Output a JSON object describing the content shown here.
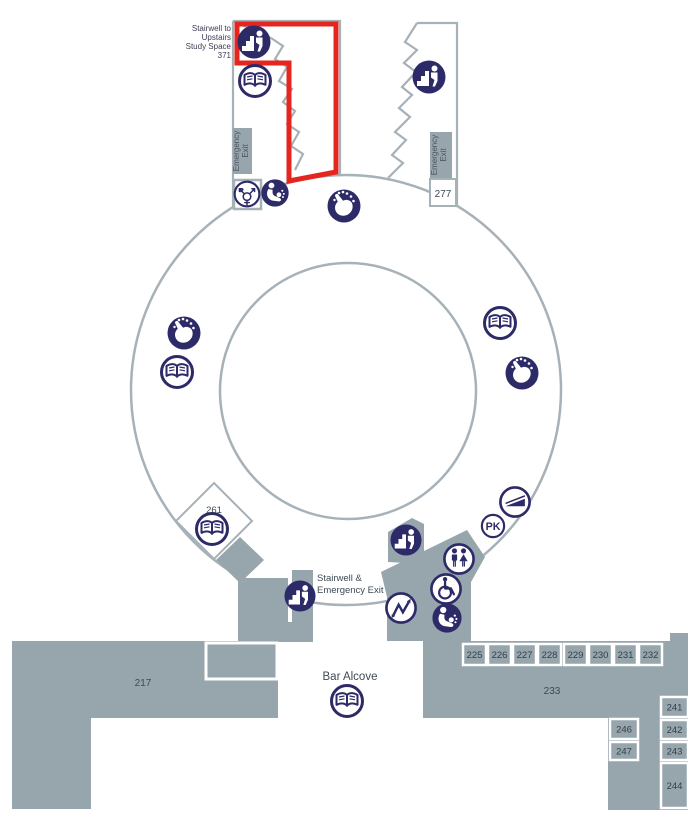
{
  "map": {
    "colors": {
      "area_gray": "#97a5ad",
      "wall_gray": "#a6b1b8",
      "icon_navy": "#2d2a68",
      "highlight_red": "#e5261f",
      "label_dark": "#3e4a54",
      "label_navy": "#3c3c55"
    },
    "highlight_label": {
      "l1": "Stairwell to",
      "l2": "Upstairs",
      "l3": "Study Space",
      "l4": "371"
    },
    "emergency_exit_label": {
      "line1": "Emergency",
      "line2": "Exit"
    },
    "stairwell_label": {
      "line1": "Stairwell &",
      "line2": "Emergency Exit"
    },
    "bar_alcove_label": "Bar Alcove",
    "pk_label": "PK",
    "room_labels": [
      {
        "id": "217",
        "x": 143,
        "y": 686,
        "s": 10
      },
      {
        "id": "233",
        "x": 552,
        "y": 694,
        "s": 10
      },
      {
        "id": "261",
        "x": 214,
        "y": 513,
        "s": 9.5
      },
      {
        "id": "277",
        "x": 443,
        "y": 197,
        "s": 10
      }
    ],
    "room_boxes": [
      {
        "id": "225",
        "x": 463,
        "y": 644,
        "w": 23,
        "h": 21
      },
      {
        "id": "226",
        "x": 488,
        "y": 644,
        "w": 23,
        "h": 21
      },
      {
        "id": "227",
        "x": 513,
        "y": 644,
        "w": 23,
        "h": 21
      },
      {
        "id": "228",
        "x": 538,
        "y": 644,
        "w": 23,
        "h": 21
      },
      {
        "id": "229",
        "x": 564,
        "y": 644,
        "w": 23,
        "h": 21
      },
      {
        "id": "230",
        "x": 589,
        "y": 644,
        "w": 23,
        "h": 21
      },
      {
        "id": "231",
        "x": 614,
        "y": 644,
        "w": 23,
        "h": 21
      },
      {
        "id": "232",
        "x": 639,
        "y": 644,
        "w": 23,
        "h": 21
      },
      {
        "id": "241",
        "x": 661,
        "y": 697,
        "w": 27,
        "h": 20
      },
      {
        "id": "242",
        "x": 661,
        "y": 720,
        "w": 27,
        "h": 19
      },
      {
        "id": "243",
        "x": 661,
        "y": 742,
        "w": 27,
        "h": 18
      },
      {
        "id": "244",
        "x": 661,
        "y": 763,
        "w": 27,
        "h": 45
      },
      {
        "id": "246",
        "x": 610,
        "y": 719,
        "w": 28,
        "h": 20
      },
      {
        "id": "247",
        "x": 610,
        "y": 742,
        "w": 28,
        "h": 18
      }
    ],
    "icons": [
      {
        "type": "stairs",
        "name": "stairwell-icon",
        "x": 254,
        "y": 42,
        "r": 17
      },
      {
        "type": "book",
        "name": "book-area-icon",
        "x": 255,
        "y": 81,
        "r": 17
      },
      {
        "type": "gender",
        "name": "all-gender-restroom-icon",
        "x": 247,
        "y": 194,
        "r": 14
      },
      {
        "type": "lactation",
        "name": "lactation-room-icon",
        "x": 275,
        "y": 193,
        "r": 15
      },
      {
        "type": "touch",
        "name": "interactive-touch-icon",
        "x": 344,
        "y": 206,
        "r": 17
      },
      {
        "type": "stairs",
        "name": "stairwell-icon",
        "x": 429,
        "y": 77,
        "r": 17
      },
      {
        "type": "touch",
        "name": "interactive-touch-icon",
        "x": 184,
        "y": 333,
        "r": 17
      },
      {
        "type": "book",
        "name": "book-area-icon",
        "x": 177,
        "y": 372,
        "r": 17
      },
      {
        "type": "book",
        "name": "book-area-icon",
        "x": 500,
        "y": 323,
        "r": 17
      },
      {
        "type": "touch",
        "name": "interactive-touch-icon",
        "x": 522,
        "y": 373,
        "r": 17
      },
      {
        "type": "scanner",
        "name": "scanner-icon",
        "x": 515,
        "y": 502,
        "r": 16
      },
      {
        "type": "pk",
        "name": "pk-icon",
        "x": 493,
        "y": 526,
        "r": 14
      },
      {
        "type": "book",
        "name": "book-area-icon",
        "x": 212,
        "y": 529,
        "r": 17
      },
      {
        "type": "stairs",
        "name": "stairwell-icon",
        "x": 406,
        "y": 540,
        "r": 16
      },
      {
        "type": "restroom",
        "name": "restroom-icon",
        "x": 459,
        "y": 559,
        "r": 16
      },
      {
        "type": "wheelchair",
        "name": "accessible-restroom-icon",
        "x": 446,
        "y": 589,
        "r": 16
      },
      {
        "type": "zigzag",
        "name": "stairs-direction-icon",
        "x": 401,
        "y": 608,
        "r": 16
      },
      {
        "type": "lactation",
        "name": "lactation-room-icon",
        "x": 447,
        "y": 618,
        "r": 16
      },
      {
        "type": "stairs",
        "name": "stairwell-icon",
        "x": 300,
        "y": 596,
        "r": 16
      },
      {
        "type": "book",
        "name": "book-area-icon",
        "x": 347,
        "y": 701,
        "r": 17
      }
    ]
  }
}
